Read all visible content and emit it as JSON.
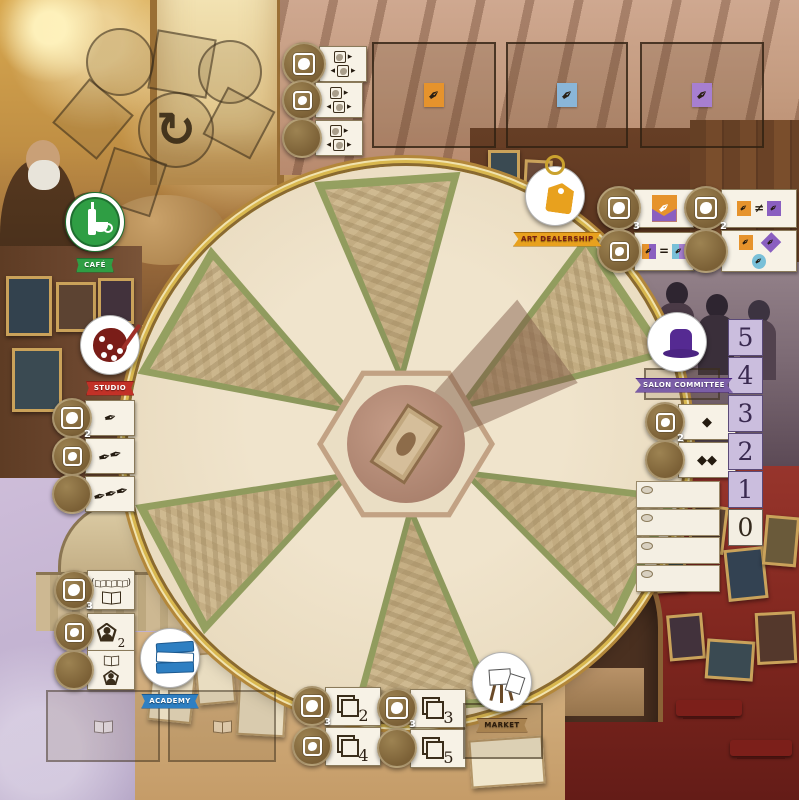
{
  "badges": {
    "cafe": {
      "label": "CAFÉ"
    },
    "studio": {
      "label": "STUDIO"
    },
    "academy": {
      "label": "ACADEMY"
    },
    "dealership": {
      "label": "ART DEALERSHIP"
    },
    "salon": {
      "label": "SALON COMMITTEE"
    },
    "market": {
      "label": "MARKET"
    }
  },
  "colors": {
    "gold_ring": "#b3873a",
    "cafe_green": "#2f9e44",
    "studio_red": "#c23127",
    "academy_blue": "#2e7fc2",
    "dealership_orange": "#e8a11e",
    "salon_purple": "#5b2d8e",
    "market_tan": "#a8824f",
    "orange_pen": "#e6932c",
    "blue_pen": "#8ab6d8",
    "purple_pen": "#a77fd0",
    "track_fill": "#cbbede",
    "red_wall": "#8a2420"
  },
  "icons": {
    "refresh": "↻",
    "nib": "✒",
    "diamond": "◆",
    "neq": "≠",
    "eq": "=",
    "arrow_right": "▸",
    "arrow_left": "◂",
    "paren_open": "(",
    "paren_close": ")"
  },
  "studio_actions": [
    {
      "sub": "2",
      "glyphs": "✒"
    },
    {
      "sub": "",
      "glyphs": "✒✒"
    },
    {
      "sub": "",
      "glyphs": "✒✒✒"
    }
  ],
  "academy_actions": {
    "row1_sub": "3",
    "row2_count": "2"
  },
  "salon_actions": [
    {
      "sub": "2",
      "glyphs": "◆"
    },
    {
      "sub": "",
      "glyphs": "◆◆"
    }
  ],
  "salon_track": {
    "numbers": [
      "5",
      "4",
      "3",
      "2",
      "1",
      "0"
    ]
  },
  "dealership_actions": {
    "left_sub": "3",
    "right_sub": "2",
    "neq": "≠",
    "eq": "="
  },
  "market_actions": {
    "left": [
      {
        "sub": "3",
        "frames": "2"
      },
      {
        "frames": "4"
      }
    ],
    "right": [
      {
        "sub": "3",
        "frames": "3"
      },
      {
        "frames": "5"
      }
    ]
  }
}
